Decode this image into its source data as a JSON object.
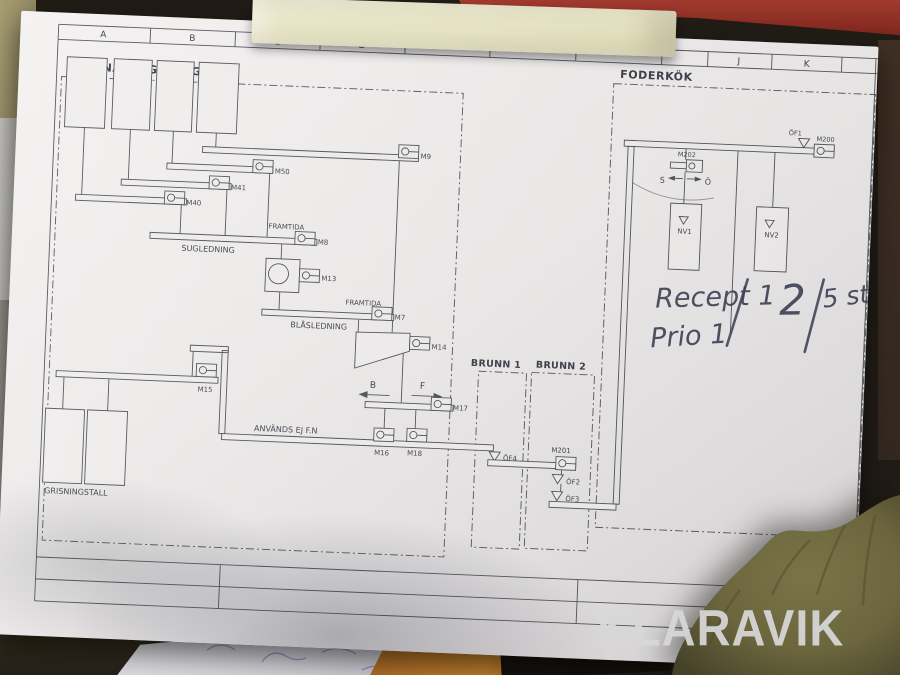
{
  "watermark": "KLARAVIK",
  "colors": {
    "paper": "#efedec",
    "line": "#52525c",
    "ink": "#3e4255",
    "tape": "#e7e4c4",
    "glove": "#6e6941",
    "red_object": "#a23a2e",
    "orange_tag": "#c8862f",
    "watermark": "#d8d8d9"
  },
  "grid_letters": [
    "A",
    "B",
    "C",
    "D",
    "J",
    "K"
  ],
  "sections": {
    "kvarn": "KVARNANLÄGGNING",
    "foderkok": "FODERKÖK",
    "brunn1": "BRUNN 1",
    "brunn2": "BRUNN 2"
  },
  "labels": {
    "m9": "M9",
    "m50": "M50",
    "m41": "M41",
    "m40": "M40",
    "m8": "M8",
    "m13": "M13",
    "m7": "M7",
    "m14": "M14",
    "m15": "M15",
    "m16": "M16",
    "m17": "M17",
    "m18": "M18",
    "m200": "M200",
    "m201": "M201",
    "m202": "M202",
    "of1": "ÖF1",
    "of2": "ÖF2",
    "of3": "ÖF3",
    "of4": "ÖF4",
    "nv1": "NV1",
    "nv2": "NV2",
    "framtida": "FRAMTIDA",
    "sugledning": "SUGLEDNING",
    "blasledning": "BLÅSLEDNING",
    "anvands": "ANVÄNDS EJ F.N",
    "grisningstall": "GRISNINGSTALL",
    "b": "B",
    "f": "F",
    "s": "S",
    "o": "Ö"
  },
  "handwriting": {
    "recept": "Recept 1",
    "prio": "Prio 1",
    "count": "2",
    "qty": "5 st"
  }
}
